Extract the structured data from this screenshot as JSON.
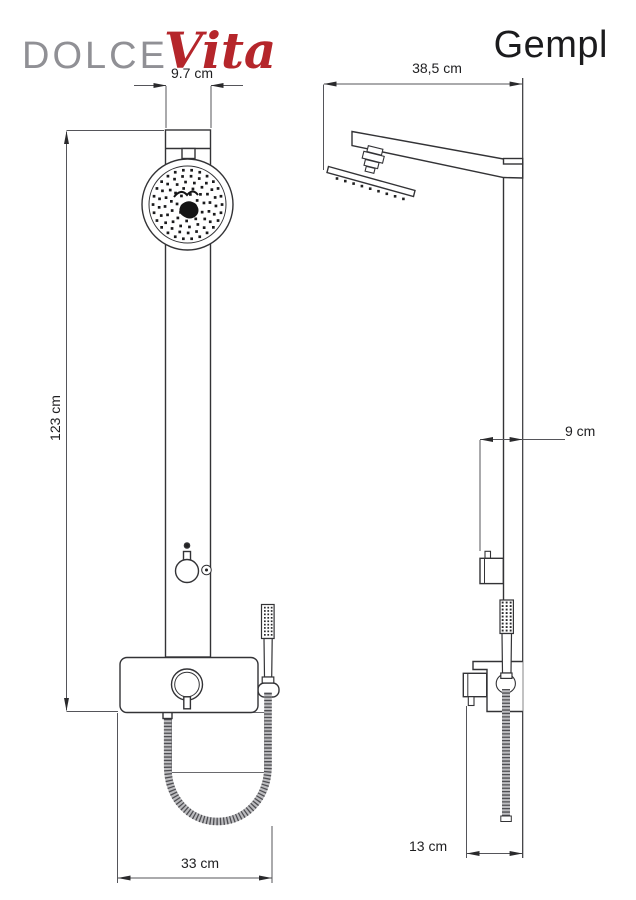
{
  "header": {
    "brand_primary": "DOLCE",
    "brand_accent": "Vita",
    "product_name": "Gempl"
  },
  "front_view": {
    "width_label": "9.7 cm",
    "height_label": "123 cm",
    "shelf_width_label": "33 cm"
  },
  "side_view": {
    "arm_length_label": "38,5 cm",
    "depth_label": "9 cm",
    "shelf_depth_label": "13 cm"
  },
  "colors": {
    "brand_gray": "#909095",
    "brand_red": "#b5262b",
    "drawing_line": "#333336",
    "dimension_line": "#55555a"
  }
}
